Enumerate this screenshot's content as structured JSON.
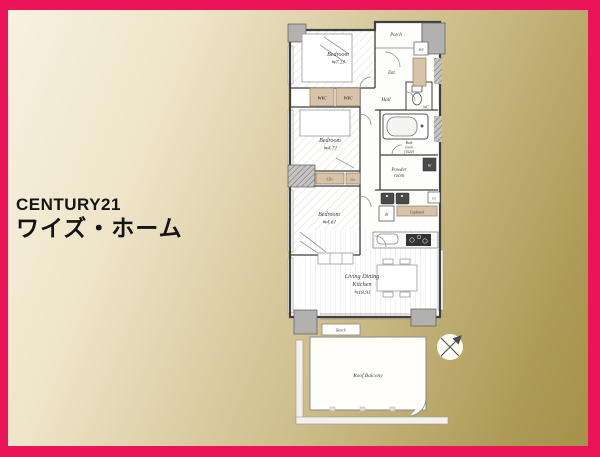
{
  "branding": {
    "line1": "CENTURY21",
    "line2": "ワイズ・ホーム"
  },
  "colors": {
    "frame_pink": "#EC1459",
    "bg_gradient_start": "#F8F2E2",
    "bg_gradient_end": "#A49147",
    "label_box_tan": "#D8C2A8",
    "wall_dark": "#3F3F3F",
    "pillar_gray": "#B3B1AF"
  },
  "floorplan": {
    "rooms": {
      "bedroom1": {
        "name": "Bedroom",
        "size": "≒7.2J"
      },
      "bedroom2": {
        "name": "Bedroom",
        "size": "≒4.7J"
      },
      "bedroom3": {
        "name": "Bedroom",
        "size": "≒4.6J"
      },
      "ldk": {
        "line1": "Living Dining",
        "line2": "Kitchen",
        "size": "≒18.9J"
      },
      "bath": {
        "line1": "Bath",
        "line2": "room",
        "line3": "(1620)"
      },
      "powder": {
        "line1": "Powder",
        "line2": "room"
      },
      "balcony": "Roof Balcony"
    },
    "labels": {
      "porch": "Porch",
      "mb": "MB",
      "ent": "Ent.",
      "wic_left": "WIC",
      "wic_right": "WIC",
      "hall": "Hall",
      "wc": "WC",
      "washer": "W",
      "clo": "Clo.",
      "sto": "Sto.",
      "fridge": "R",
      "cupboard": "Cupboard",
      "ps": "PS",
      "bench": "Bench"
    }
  }
}
